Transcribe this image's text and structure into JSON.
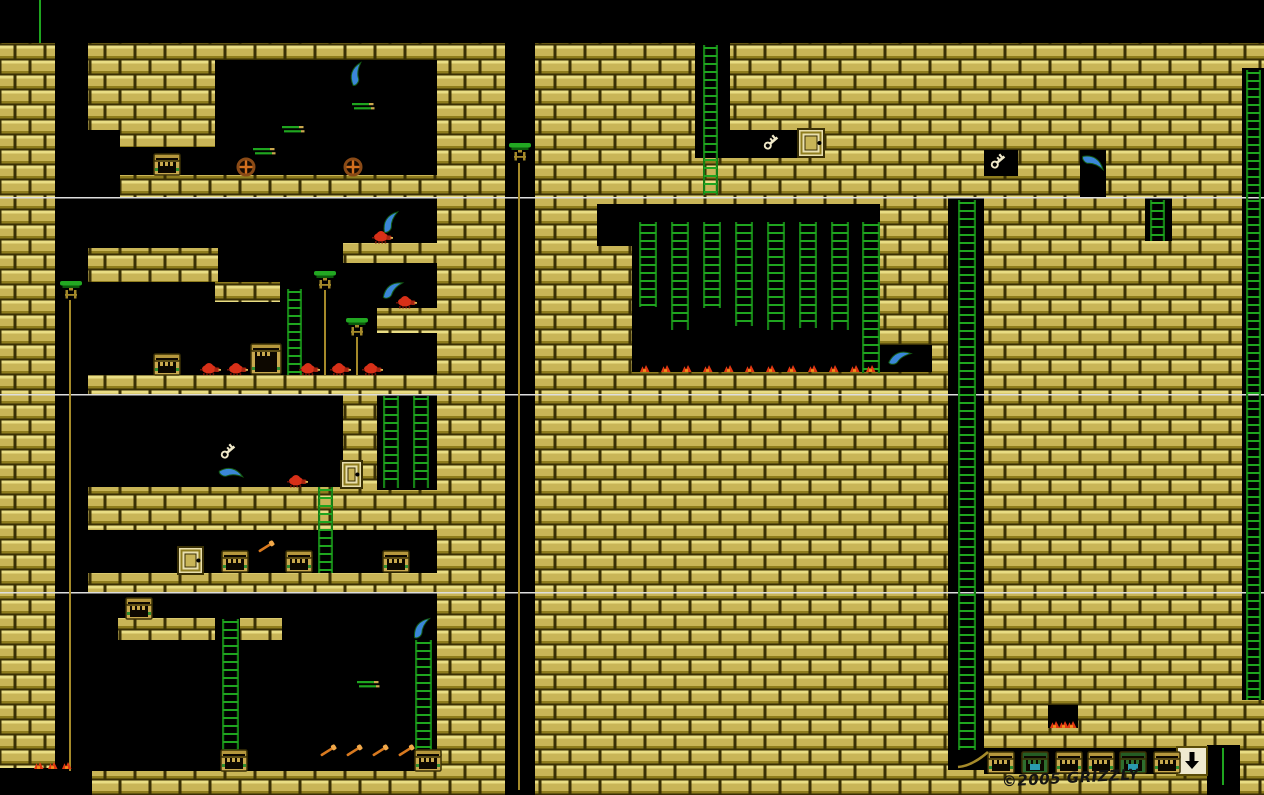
{
  "meta": {
    "title": "Dungeon platformer level map",
    "canvas": {
      "w": 1264,
      "h": 795
    },
    "author_credit": "©2005 GRIZZLY"
  },
  "signature": {
    "text": "©2005 GRIZZLY"
  },
  "palette": {
    "background": "#000000",
    "brick": "#c9b557",
    "brick_highlight": "#e9dd84",
    "brick_shadow": "#8f7d1e",
    "mortar": "#3a3005",
    "ladder_green": "#1fa51f",
    "rail_green": "#157f15",
    "pedestal_green": "#22a822",
    "pole_tan": "#a58a2a",
    "scimitar_blue": "#3b86d8",
    "enemy_red": "#d83018",
    "wheel_orange": "#d4701e",
    "key_ivory": "#efe8c8",
    "door_tan": "#e9dfad",
    "chest_tan": "#c9a94e",
    "chest_green": "#2e6e2e",
    "pickaxe_orange": "#d8791f",
    "flame_red": "#e23812",
    "flame_orange": "#f2901a",
    "divider_white": "#dedede"
  },
  "map": {
    "brick_base": {
      "x": 0,
      "y": 43,
      "w": 1264,
      "h": 752
    },
    "black_regions": [
      {
        "x": 0,
        "y": 0,
        "w": 1264,
        "h": 43
      },
      {
        "x": 55,
        "y": 43,
        "w": 33,
        "h": 728
      },
      {
        "x": 0,
        "y": 768,
        "w": 92,
        "h": 27
      },
      {
        "x": 88,
        "y": 130,
        "w": 32,
        "h": 67
      },
      {
        "x": 215,
        "y": 60,
        "w": 222,
        "h": 115
      },
      {
        "x": 120,
        "y": 147,
        "w": 95,
        "h": 28
      },
      {
        "x": 505,
        "y": 43,
        "w": 30,
        "h": 752
      },
      {
        "x": 88,
        "y": 197,
        "w": 349,
        "h": 178
      },
      {
        "x": 632,
        "y": 204,
        "w": 248,
        "h": 168
      },
      {
        "x": 597,
        "y": 204,
        "w": 35,
        "h": 42
      },
      {
        "x": 695,
        "y": 43,
        "w": 35,
        "h": 115
      },
      {
        "x": 730,
        "y": 130,
        "w": 72,
        "h": 28
      },
      {
        "x": 878,
        "y": 345,
        "w": 54,
        "h": 27
      },
      {
        "x": 948,
        "y": 197,
        "w": 36,
        "h": 573
      },
      {
        "x": 984,
        "y": 150,
        "w": 34,
        "h": 26
      },
      {
        "x": 1080,
        "y": 150,
        "w": 26,
        "h": 47
      },
      {
        "x": 1145,
        "y": 197,
        "w": 27,
        "h": 44
      },
      {
        "x": 1242,
        "y": 68,
        "w": 22,
        "h": 632
      },
      {
        "x": 88,
        "y": 394,
        "w": 255,
        "h": 93
      },
      {
        "x": 377,
        "y": 394,
        "w": 60,
        "h": 96
      },
      {
        "x": 88,
        "y": 530,
        "w": 349,
        "h": 43
      },
      {
        "x": 88,
        "y": 592,
        "w": 349,
        "h": 179
      },
      {
        "x": 1048,
        "y": 705,
        "w": 30,
        "h": 23
      },
      {
        "x": 984,
        "y": 748,
        "w": 194,
        "h": 26
      },
      {
        "x": 1207,
        "y": 745,
        "w": 33,
        "h": 50
      }
    ],
    "brick_platforms": [
      {
        "x": 88,
        "y": 248,
        "w": 130,
        "h": 34
      },
      {
        "x": 215,
        "y": 282,
        "w": 65,
        "h": 20
      },
      {
        "x": 343,
        "y": 243,
        "w": 94,
        "h": 20
      },
      {
        "x": 377,
        "y": 308,
        "w": 60,
        "h": 25
      },
      {
        "x": 118,
        "y": 618,
        "w": 97,
        "h": 22
      },
      {
        "x": 240,
        "y": 618,
        "w": 42,
        "h": 22
      }
    ],
    "screen_dividers": [
      {
        "x": 0,
        "y": 197,
        "w": 1264,
        "h": 1.5
      },
      {
        "x": 0,
        "y": 394,
        "w": 1264,
        "h": 1.5
      },
      {
        "x": 0,
        "y": 592,
        "w": 1264,
        "h": 1.5
      }
    ],
    "ropes": [
      {
        "x": 39,
        "y": 0,
        "w": 2,
        "h": 43
      },
      {
        "x": 1222,
        "y": 748,
        "w": 2,
        "h": 37
      }
    ],
    "poles": [
      {
        "x": 518,
        "y": 163,
        "w": 2,
        "h": 627
      },
      {
        "x": 69,
        "y": 300,
        "w": 2,
        "h": 471
      },
      {
        "x": 324,
        "y": 290,
        "w": 2,
        "h": 85
      },
      {
        "x": 356,
        "y": 337,
        "w": 2,
        "h": 38
      }
    ],
    "ladders": [
      {
        "x": 703,
        "y": 45,
        "w": 15,
        "h": 150
      },
      {
        "x": 639,
        "y": 222,
        "w": 18,
        "h": 85
      },
      {
        "x": 671,
        "y": 222,
        "w": 18,
        "h": 108
      },
      {
        "x": 703,
        "y": 222,
        "w": 18,
        "h": 86
      },
      {
        "x": 735,
        "y": 222,
        "w": 18,
        "h": 104
      },
      {
        "x": 767,
        "y": 222,
        "w": 18,
        "h": 108
      },
      {
        "x": 799,
        "y": 222,
        "w": 18,
        "h": 106
      },
      {
        "x": 831,
        "y": 222,
        "w": 18,
        "h": 108
      },
      {
        "x": 862,
        "y": 222,
        "w": 18,
        "h": 151
      },
      {
        "x": 287,
        "y": 289,
        "w": 15,
        "h": 86
      },
      {
        "x": 383,
        "y": 396,
        "w": 16,
        "h": 92
      },
      {
        "x": 413,
        "y": 396,
        "w": 16,
        "h": 92
      },
      {
        "x": 318,
        "y": 487,
        "w": 15,
        "h": 86
      },
      {
        "x": 222,
        "y": 619,
        "w": 17,
        "h": 150
      },
      {
        "x": 415,
        "y": 640,
        "w": 17,
        "h": 129
      },
      {
        "x": 958,
        "y": 200,
        "w": 18,
        "h": 550
      },
      {
        "x": 1246,
        "y": 70,
        "w": 15,
        "h": 630
      },
      {
        "x": 1150,
        "y": 200,
        "w": 15,
        "h": 41
      }
    ],
    "pedestals": [
      {
        "x": 509,
        "y": 143
      },
      {
        "x": 60,
        "y": 281
      },
      {
        "x": 314,
        "y": 271
      },
      {
        "x": 346,
        "y": 318
      }
    ],
    "scimitars": [
      {
        "x": 347,
        "y": 64,
        "rot": -30
      },
      {
        "x": 381,
        "y": 212,
        "rot": -15
      },
      {
        "x": 383,
        "y": 280,
        "rot": 5
      },
      {
        "x": 890,
        "y": 348,
        "rot": 20
      },
      {
        "x": 1083,
        "y": 153,
        "rot": 75
      },
      {
        "x": 221,
        "y": 464,
        "rot": 55
      },
      {
        "x": 412,
        "y": 618,
        "rot": -10
      }
    ],
    "keys": [
      {
        "x": 761,
        "y": 132,
        "rot": -40
      },
      {
        "x": 988,
        "y": 151,
        "rot": -40
      },
      {
        "x": 218,
        "y": 441,
        "rot": -40
      }
    ],
    "doors": [
      {
        "x": 798,
        "y": 129,
        "w": 26,
        "h": 28
      },
      {
        "x": 341,
        "y": 461,
        "w": 21,
        "h": 27
      },
      {
        "x": 178,
        "y": 547,
        "w": 25,
        "h": 27
      }
    ],
    "exit_door": {
      "x": 1177,
      "y": 747,
      "w": 30,
      "h": 28,
      "arrow_direction": "down"
    },
    "chests": [
      {
        "x": 154,
        "y": 154,
        "type": "tan"
      },
      {
        "x": 154,
        "y": 354,
        "type": "tan"
      },
      {
        "x": 251,
        "y": 344,
        "type": "big"
      },
      {
        "x": 126,
        "y": 598,
        "type": "tan"
      },
      {
        "x": 222,
        "y": 551,
        "type": "tan"
      },
      {
        "x": 286,
        "y": 551,
        "type": "tan"
      },
      {
        "x": 383,
        "y": 551,
        "type": "tan"
      },
      {
        "x": 221,
        "y": 750,
        "type": "tan"
      },
      {
        "x": 415,
        "y": 750,
        "type": "tan"
      },
      {
        "x": 988,
        "y": 752,
        "type": "tan"
      },
      {
        "x": 1022,
        "y": 752,
        "type": "green"
      },
      {
        "x": 1056,
        "y": 752,
        "type": "tan"
      },
      {
        "x": 1088,
        "y": 752,
        "type": "tan"
      },
      {
        "x": 1120,
        "y": 752,
        "type": "green"
      },
      {
        "x": 1154,
        "y": 752,
        "type": "tan"
      }
    ],
    "enemies": [
      {
        "x": 372,
        "y": 230
      },
      {
        "x": 396,
        "y": 295
      },
      {
        "x": 200,
        "y": 362
      },
      {
        "x": 227,
        "y": 362
      },
      {
        "x": 299,
        "y": 362
      },
      {
        "x": 330,
        "y": 362
      },
      {
        "x": 362,
        "y": 362
      },
      {
        "x": 287,
        "y": 474
      }
    ],
    "wheels": [
      {
        "cx": 246,
        "cy": 167
      },
      {
        "cx": 353,
        "cy": 167
      }
    ],
    "blade_bars": [
      {
        "x": 253,
        "y": 148
      },
      {
        "x": 282,
        "y": 126
      },
      {
        "x": 352,
        "y": 103
      },
      {
        "x": 357,
        "y": 681
      }
    ],
    "pickaxes": [
      {
        "x": 256,
        "y": 547
      },
      {
        "x": 318,
        "y": 751
      },
      {
        "x": 344,
        "y": 751
      },
      {
        "x": 370,
        "y": 751
      },
      {
        "x": 396,
        "y": 751
      }
    ],
    "flames": [
      {
        "x": 640,
        "y": 365
      },
      {
        "x": 661,
        "y": 365
      },
      {
        "x": 682,
        "y": 365
      },
      {
        "x": 703,
        "y": 365
      },
      {
        "x": 724,
        "y": 365
      },
      {
        "x": 745,
        "y": 365
      },
      {
        "x": 766,
        "y": 365
      },
      {
        "x": 787,
        "y": 365
      },
      {
        "x": 808,
        "y": 365
      },
      {
        "x": 829,
        "y": 365
      },
      {
        "x": 850,
        "y": 365
      },
      {
        "x": 866,
        "y": 365
      },
      {
        "x": 1050,
        "y": 721
      },
      {
        "x": 1059,
        "y": 721
      },
      {
        "x": 1067,
        "y": 721
      },
      {
        "x": 34,
        "y": 762
      },
      {
        "x": 48,
        "y": 762
      },
      {
        "x": 62,
        "y": 762
      }
    ],
    "rope_curve": {
      "x1": 958,
      "y1": 767,
      "cx": 972,
      "cy": 766,
      "x2": 988,
      "y2": 752
    }
  }
}
